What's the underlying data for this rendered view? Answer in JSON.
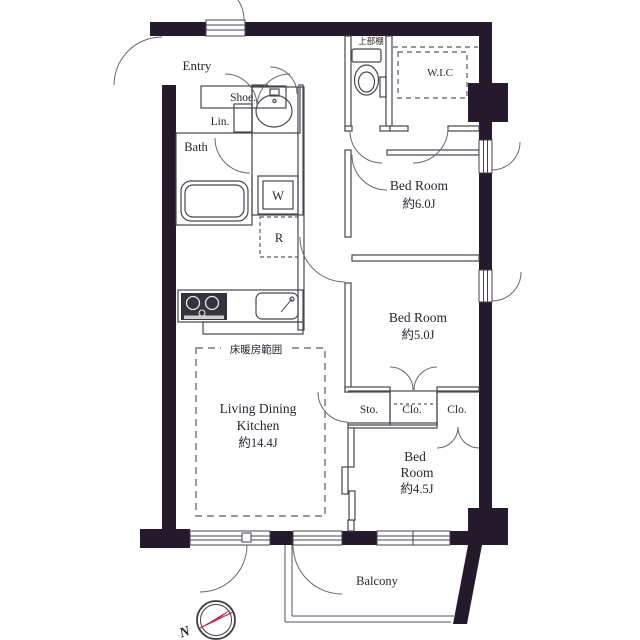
{
  "floorplan": {
    "labels": {
      "entry": "Entry",
      "shoe": "Shoe.",
      "lin": "Lin.",
      "bath": "Bath",
      "washer": "W",
      "fridge": "R",
      "upper_shelf": "上部棚",
      "wic": "W.I.C",
      "bedroom1": {
        "name": "Bed Room",
        "size": "約6.0J"
      },
      "bedroom2": {
        "name": "Bed Room",
        "size": "約5.0J"
      },
      "bedroom3": {
        "line1": "Bed",
        "line2": "Room",
        "size": "約4.5J"
      },
      "ldk": {
        "line1": "Living Dining",
        "line2": "Kitchen",
        "size": "約14.4J"
      },
      "storage": "Sto.",
      "closet_middle": "Clo.",
      "closet_right": "Clo.",
      "balcony": "Balcony",
      "floor_heating": "床暖房範囲",
      "compass_north": "N"
    },
    "colors": {
      "wall": "#241a2b",
      "line": "#4a4450",
      "text": "#26262e",
      "compass_accent": "#c22553",
      "background": "#ffffff"
    }
  }
}
